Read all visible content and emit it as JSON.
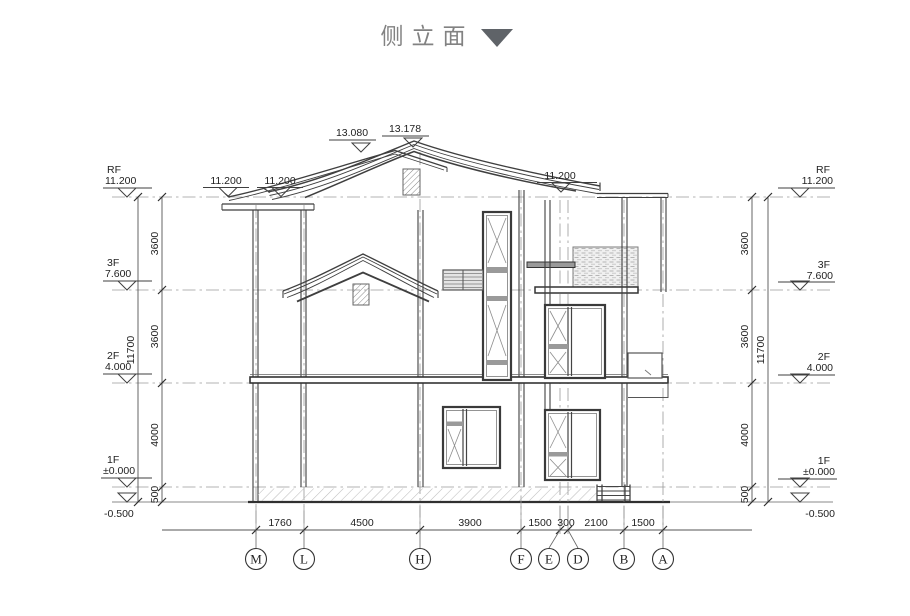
{
  "title": {
    "text": "侧立面"
  },
  "roof_marks": [
    {
      "value": "13.080"
    },
    {
      "value": "13.178"
    }
  ],
  "eave_marks": [
    {
      "value": "11.200"
    },
    {
      "value": "11.200"
    },
    {
      "value": "11.200"
    }
  ],
  "levels_left": [
    {
      "name": "RF",
      "value": "11.200"
    },
    {
      "name": "3F",
      "value": "7.600"
    },
    {
      "name": "2F",
      "value": "4.000"
    },
    {
      "name": "1F",
      "value": "±0.000"
    },
    {
      "name": "",
      "value": "-0.500"
    }
  ],
  "levels_right": [
    {
      "name": "RF",
      "value": "11.200"
    },
    {
      "name": "3F",
      "value": "7.600"
    },
    {
      "name": "2F",
      "value": "4.000"
    },
    {
      "name": "1F",
      "value": "±0.000"
    },
    {
      "name": "",
      "value": "-0.500"
    }
  ],
  "vdims_left": {
    "segments": [
      "3600",
      "3600",
      "4000",
      "500"
    ],
    "total": "11700"
  },
  "vdims_right": {
    "segments": [
      "3600",
      "3600",
      "4000",
      "500"
    ],
    "total": "11700"
  },
  "hdims": [
    "1760",
    "4500",
    "3900",
    "1500",
    "300",
    "2100",
    "1500"
  ],
  "grids": [
    "M",
    "L",
    "H",
    "F",
    "E",
    "D",
    "B",
    "A"
  ],
  "colors": {
    "line": "#3f3f3f",
    "grid_line": "#9a9a9a",
    "title_text": "#828282",
    "title_triangle": "#5f6368",
    "hatch": "#b8b8b8"
  }
}
